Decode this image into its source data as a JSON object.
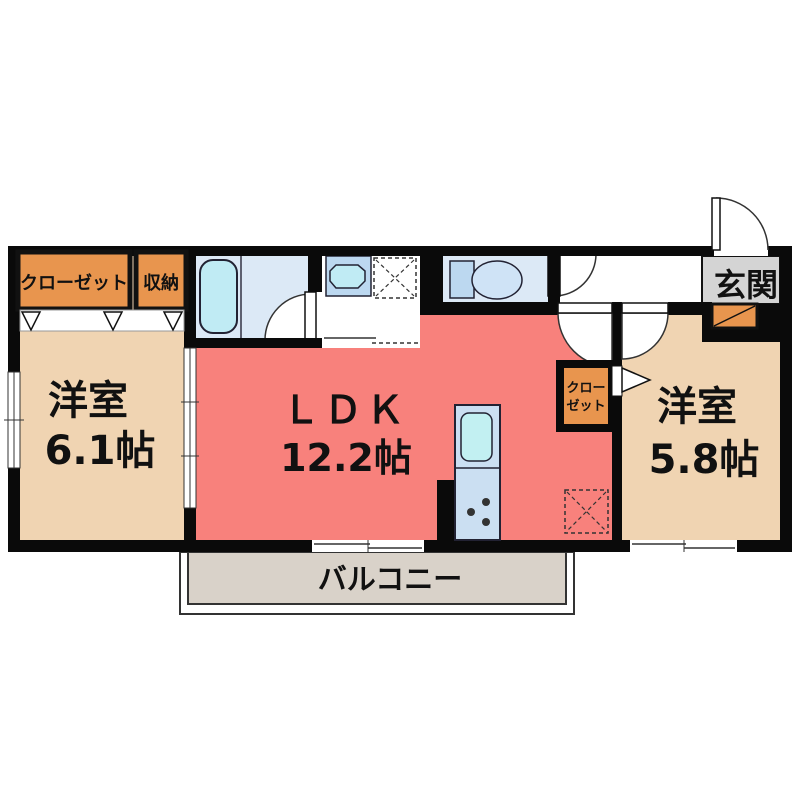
{
  "plan_title": "1LDK apartment floor plan",
  "rooms": {
    "closet_left": {
      "label": "クローゼット"
    },
    "storage": {
      "label": "収納"
    },
    "room_left": {
      "name": "洋室",
      "size": "6.1帖"
    },
    "ldk": {
      "name": "ＬＤＫ",
      "size": "12.2帖"
    },
    "closet_mid": {
      "line1": "クロー",
      "line2": "ゼット"
    },
    "room_right": {
      "name": "洋室",
      "size": "5.8帖"
    },
    "entrance": {
      "label": "玄関"
    },
    "balcony": {
      "label": "バルコニー"
    }
  },
  "fixtures": {
    "bathtub": "bathtub",
    "washbasin": "washbasin",
    "washing_machine_space": "washing-machine-space",
    "toilet": "toilet",
    "kitchen_counter": "kitchen-counter-with-sink-and-stove",
    "refrigerator_space": "refrigerator-space",
    "shoe_cabinet": "shoe-cabinet"
  },
  "colors": {
    "wall": "#0a0a0a",
    "room_tan": "#f0d4b2",
    "ldk_salmon": "#f8817c",
    "closet_orange": "#e8954e",
    "wet_area_blue": "#dce9f6",
    "tub_cyan": "#c0ebf4",
    "fixture_blue": "#bcd8f0",
    "kitchen_blue": "#cbdff2",
    "entrance_gray": "#d4d4d4",
    "balcony_gray": "#d9d2c9"
  }
}
